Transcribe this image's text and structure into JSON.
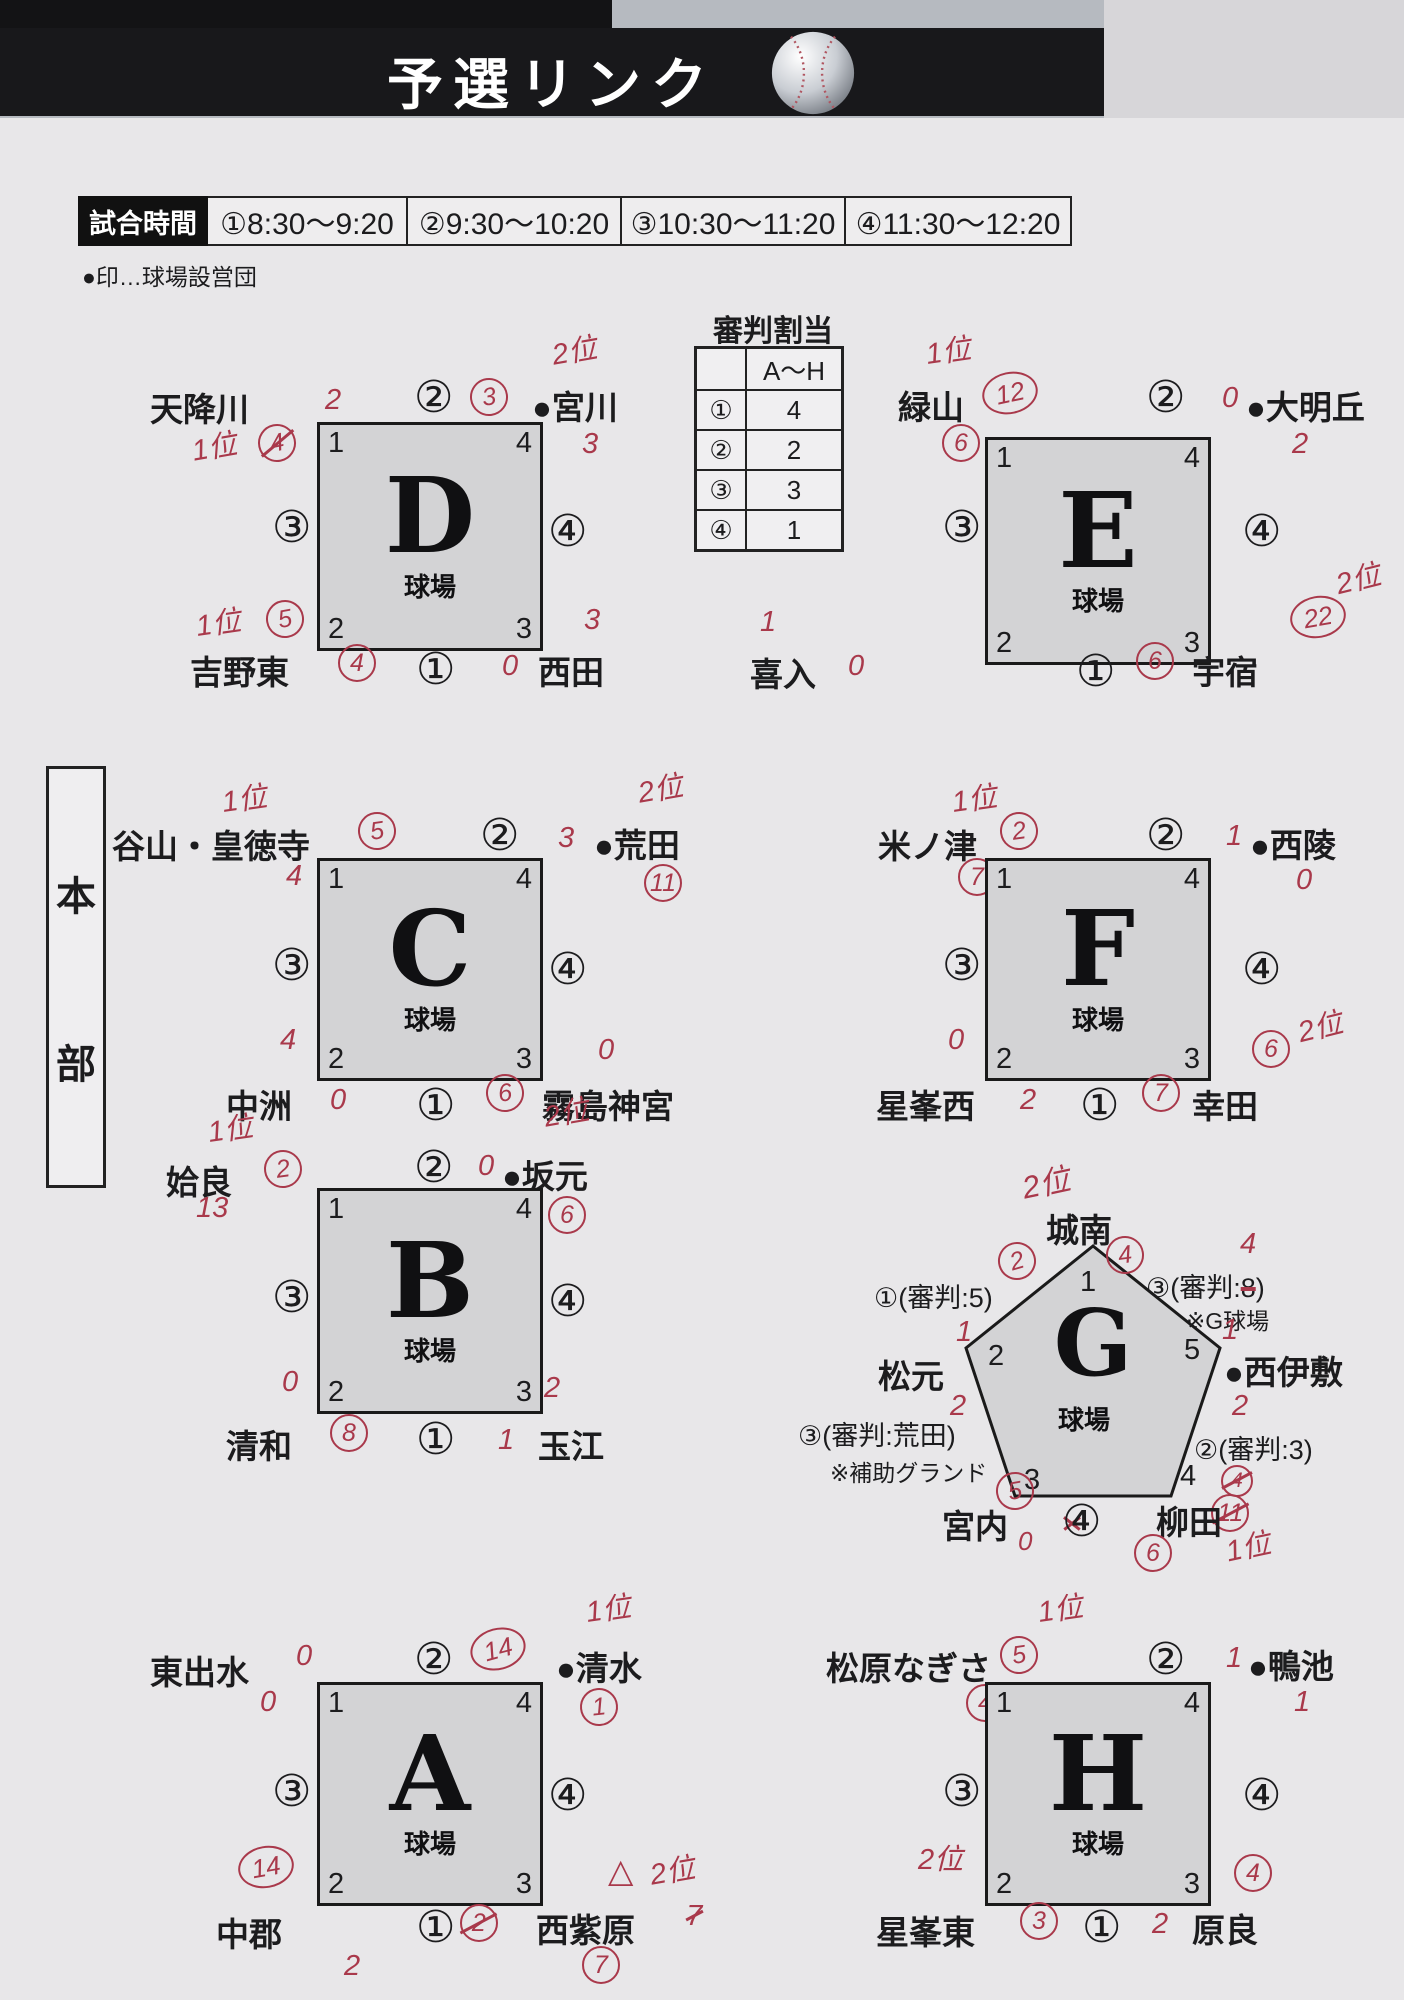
{
  "header": {
    "title": "予選リンク"
  },
  "schedule": {
    "label": "試合時間",
    "slots": [
      "①8:30～9:20",
      "②9:30～10:20",
      "③10:30～11:20",
      "④11:30～12:20"
    ],
    "note": "●印…球場設営団"
  },
  "referee_table": {
    "title": "審判割当",
    "range_header": "A～H",
    "rows": [
      {
        "slot": "①",
        "count": "4"
      },
      {
        "slot": "②",
        "count": "2"
      },
      {
        "slot": "③",
        "count": "3"
      },
      {
        "slot": "④",
        "count": "1"
      }
    ]
  },
  "hq": {
    "char1": "本",
    "char2": "部"
  },
  "blocks": {
    "D": {
      "letter": "D",
      "venue": "球場",
      "corners": {
        "tl": "1",
        "tr": "4",
        "bl": "2",
        "br": "3"
      },
      "matches": {
        "top": "②",
        "left": "③",
        "right": "④",
        "bottom": "①"
      },
      "teams": {
        "tl": "天降川",
        "tr": "●宮川",
        "bl": "吉野東",
        "br": "西田"
      },
      "red": {
        "tl_score": "2",
        "rank_x": "1位",
        "rank_x_num": "4",
        "top_circ": "3",
        "tr_rank": "2位",
        "tr_score": "3",
        "bl_rank": "1位",
        "bl_above": "5",
        "bl_circ": "4",
        "br_zero": "0",
        "br_above": "3"
      }
    },
    "E": {
      "letter": "E",
      "venue": "球場",
      "corners": {
        "tl": "1",
        "tr": "4",
        "bl": "2",
        "br": "3"
      },
      "matches": {
        "top": "②",
        "left": "③",
        "right": "④",
        "bottom": "①"
      },
      "teams": {
        "tl": "緑山",
        "tr": "●大明丘",
        "bl": "喜入",
        "br": "宇宿"
      },
      "red": {
        "rank": "1位",
        "tl_circ": "12",
        "tl_below": "6",
        "top_zero": "0",
        "tr_score": "2",
        "bl_above": "1",
        "bl_score": "0",
        "br_circ": "6",
        "br_big": "22",
        "br_rank": "2位"
      }
    },
    "C": {
      "letter": "C",
      "venue": "球場",
      "corners": {
        "tl": "1",
        "tr": "4",
        "bl": "2",
        "br": "3"
      },
      "matches": {
        "top": "②",
        "left": "③",
        "right": "④",
        "bottom": "①"
      },
      "teams": {
        "tl": "谷山・皇徳寺",
        "tr": "●荒田",
        "bl": "中洲",
        "br": "霧島神宮"
      },
      "red": {
        "rank": "1位",
        "tl_circ": "5",
        "top_score": "3",
        "tr_rank": "2位",
        "tr_below": "11",
        "left_top": "4",
        "left_bottom": "4",
        "bl_score": "0",
        "br_circ": "6",
        "br_above": "0"
      }
    },
    "F": {
      "letter": "F",
      "venue": "球場",
      "corners": {
        "tl": "1",
        "tr": "4",
        "bl": "2",
        "br": "3"
      },
      "matches": {
        "top": "②",
        "left": "③",
        "right": "④",
        "bottom": "①"
      },
      "teams": {
        "tl": "米ノ津",
        "tr": "●西陵",
        "bl": "星峯西",
        "br": "幸田"
      },
      "red": {
        "rank": "1位",
        "tl_circ": "2",
        "tl_below": "7",
        "top_score": "1",
        "tr_below": "0",
        "left_bottom": "0",
        "bl_score": "2",
        "br_circ": "7",
        "br_above": "6",
        "br_rank": "2位"
      }
    },
    "B": {
      "letter": "B",
      "venue": "球場",
      "corners": {
        "tl": "1",
        "tr": "4",
        "bl": "2",
        "br": "3"
      },
      "matches": {
        "top": "②",
        "left": "③",
        "right": "④",
        "bottom": "①"
      },
      "teams": {
        "tl": "姶良",
        "tr": "●坂元",
        "bl": "清和",
        "br": "玉江"
      },
      "red": {
        "rank": "1位",
        "tl_circ": "2",
        "tl_below": "13",
        "top_zero": "0",
        "tr_rank": "2位",
        "tr_below": "6",
        "left_bottom": "0",
        "bl_circ": "8",
        "bottom_score": "1",
        "br_above": "2"
      }
    },
    "A": {
      "letter": "A",
      "venue": "球場",
      "corners": {
        "tl": "1",
        "tr": "4",
        "bl": "2",
        "br": "3"
      },
      "matches": {
        "top": "②",
        "left": "③",
        "right": "④",
        "bottom": "①"
      },
      "teams": {
        "tl": "東出水",
        "tr": "●清水",
        "bl": "中郡",
        "br": "西紫原"
      },
      "red": {
        "tl_score": "0",
        "tl_below": "0",
        "top_circ": "14",
        "tr_rank": "1位",
        "tr_below": "1",
        "left_circ": "14",
        "bl_x": "2",
        "bl_below": "2",
        "bottom_x": "7",
        "br_tri": "△",
        "br_rank": "2位",
        "br_below": "7"
      }
    },
    "H": {
      "letter": "H",
      "venue": "球場",
      "corners": {
        "tl": "1",
        "tr": "4",
        "bl": "2",
        "br": "3"
      },
      "matches": {
        "top": "②",
        "left": "③",
        "right": "④",
        "bottom": "①"
      },
      "teams": {
        "tl": "松原なぎさ",
        "tr": "●鴨池",
        "bl": "星峯東",
        "br": "原良"
      },
      "red": {
        "rank": "1位",
        "tl_circ": "5",
        "tl_below": "4",
        "top_score": "1",
        "tr_below": "1",
        "left_rank": "2位",
        "left_zero": "0",
        "bl_circ": "3",
        "bottom_score": "2",
        "br_above": "4"
      }
    },
    "G": {
      "letter": "G",
      "venue": "球場",
      "vertices": {
        "v1": "1",
        "v2": "2",
        "v3": "3",
        "v4": "4",
        "v5": "5"
      },
      "teams": {
        "top": "城南",
        "left": "松元",
        "right": "●西伊敷",
        "bl": "宮内",
        "br": "柳田"
      },
      "labels": {
        "ul": "①(審判:5)",
        "ur_pre": "③(審判:",
        "ur_struck": "8",
        "ur_post": ")",
        "ur_fix": "4",
        "ur_note": "※G球場",
        "ll": "③(審判:荒田)",
        "ll_note": "※補助グランド",
        "lr": "②(審判:3)",
        "bottom_match": "④",
        "bottom_label": "(審判:1)"
      },
      "red": {
        "top_rank": "2位",
        "v1_left": "2",
        "v1_right": "4",
        "left_above": "1",
        "left_below": "2",
        "right_above": "1",
        "right_below": "2",
        "v3_circ": "5",
        "bl_zero": "0",
        "br_above_x": "4",
        "br_x": "11",
        "br_circ": "6",
        "br_rank": "1位"
      }
    }
  }
}
